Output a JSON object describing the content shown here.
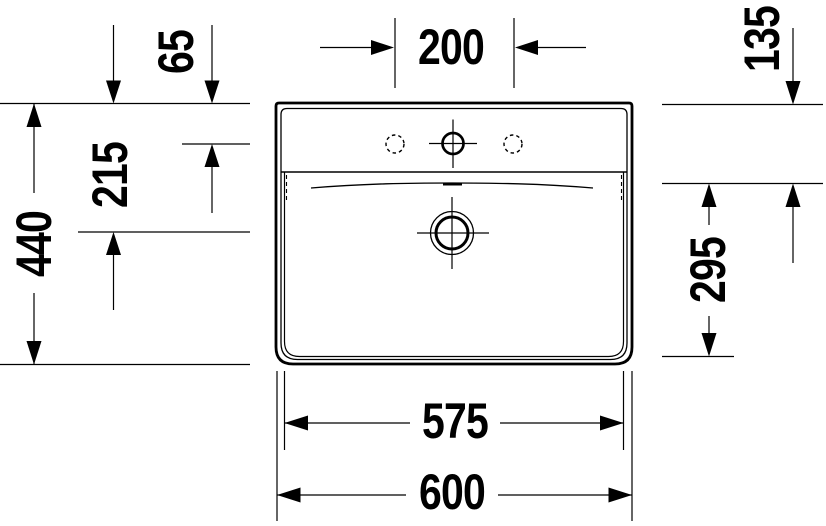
{
  "labels": {
    "d65": "65",
    "d200": "200",
    "d135": "135",
    "d215": "215",
    "d440": "440",
    "d295": "295",
    "d575": "575",
    "d600": "600"
  },
  "drawing": {
    "description": "Top-view dimension drawing of a rectangular washbasin with three tap holes and a central drain",
    "line_color": "#000000",
    "background_color": "#ffffff",
    "dimensions": [
      {
        "value": "65",
        "orientation": "vertical",
        "location": "top-left"
      },
      {
        "value": "200",
        "orientation": "horizontal",
        "location": "top-center"
      },
      {
        "value": "135",
        "orientation": "vertical",
        "location": "top-right"
      },
      {
        "value": "215",
        "orientation": "vertical",
        "location": "left"
      },
      {
        "value": "440",
        "orientation": "vertical",
        "location": "left-outer"
      },
      {
        "value": "295",
        "orientation": "vertical",
        "location": "right"
      },
      {
        "value": "575",
        "orientation": "horizontal",
        "location": "bottom-inner"
      },
      {
        "value": "600",
        "orientation": "horizontal",
        "location": "bottom-outer"
      }
    ]
  }
}
